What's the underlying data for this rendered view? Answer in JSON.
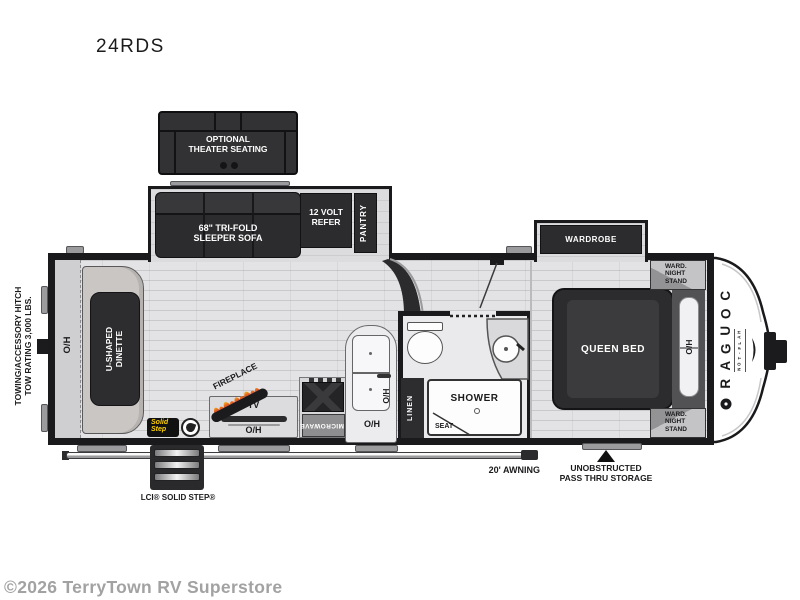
{
  "title": "24RDS",
  "watermark": "©2026 TerryTown RV Superstore",
  "colors": {
    "wall": "#1a1a1c",
    "furniture_dark": "#2c2c2e",
    "floor": "#e3e3e5",
    "flame_orange": "#f08c1e",
    "flame_red": "#e0481e",
    "solid_step_yellow": "#ffd200",
    "watermark_gray": "#a2a2a2"
  },
  "floorplan": {
    "theater": {
      "line1": "OPTIONAL",
      "line2": "THEATER SEATING"
    },
    "sofa": {
      "line1": "68\" TRI-FOLD",
      "line2": "SLEEPER SOFA"
    },
    "refer": {
      "line1": "12 VOLT",
      "line2": "REFER"
    },
    "pantry": {
      "label": "PANTRY"
    },
    "wardrobe": {
      "label": "WARDROBE"
    },
    "queen_bed": {
      "label": "QUEEN BED"
    },
    "nightstand": {
      "line1": "WARD.",
      "line2": "NIGHT",
      "line3": "STAND"
    },
    "dinette": {
      "line1": "U-SHAPED",
      "line2": "DINETTE"
    },
    "overhead": {
      "rear": "O/H",
      "island": "O/H",
      "kitchen": "O/H",
      "tv": "O/H",
      "bedroom": "O/H"
    },
    "fireplace": {
      "label": "FIREPLACE"
    },
    "tv": {
      "label": "TV"
    },
    "microwave": {
      "label": "MICROWAVE"
    },
    "shower": {
      "label": "SHOWER"
    },
    "seat": {
      "label": "SEAT"
    },
    "linen": {
      "label": "LINEN"
    },
    "hitch_note": {
      "line1": "TOWING/ACCESSORY HITCH",
      "line2": "TOW RATING 3,000 LBS."
    },
    "brand": {
      "name": "COUGAR",
      "sub": "HALF-TON"
    },
    "solid_step_logo": {
      "line1": "Solid",
      "line2": "Step"
    },
    "annotations": {
      "step_label": "LCI® SOLID STEP®",
      "awning_label": "20' AWNING",
      "storage_line1": "UNOBSTRUCTED",
      "storage_line2": "PASS THRU STORAGE"
    }
  }
}
